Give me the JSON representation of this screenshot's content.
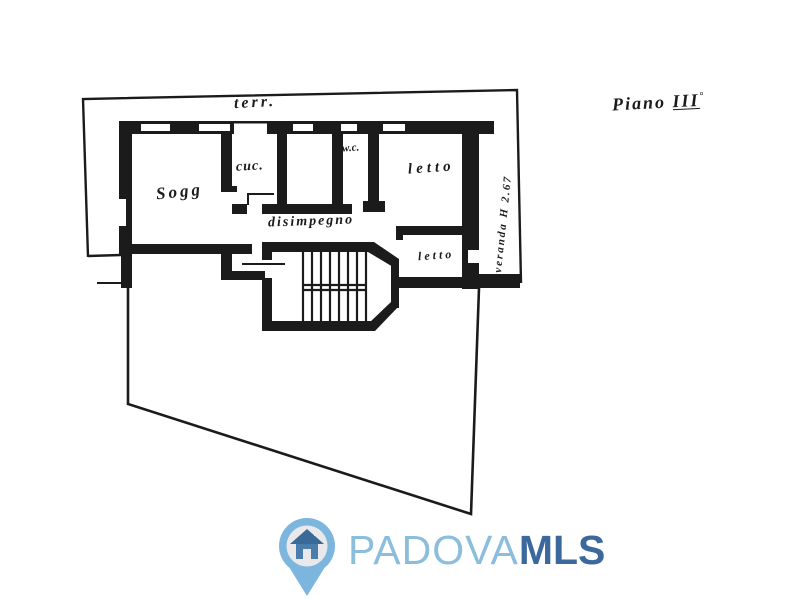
{
  "plan": {
    "floor_label": {
      "prefix": "Piano",
      "numeral": "III",
      "degree": "°"
    },
    "rooms": {
      "terrace": "terr.",
      "living": "Sogg",
      "kitchen": "cuc.",
      "wc": "w.c.",
      "bedroom_top": "letto",
      "hallway": "disimpegno",
      "bedroom_bottom": "letto",
      "veranda": "veranda H 2.67"
    },
    "ink_color": "#1b1b1b"
  },
  "watermark": {
    "brand_primary": "PADOVA",
    "brand_secondary": "MLS",
    "pin_color": "#7cb6de",
    "pin_inner_color": "#e9e9eb",
    "house_roof_color": "#3b6a99",
    "house_body_color": "#4a7dab",
    "text_primary_color": "#8bbedd",
    "text_secondary_color": "#3d689e"
  }
}
